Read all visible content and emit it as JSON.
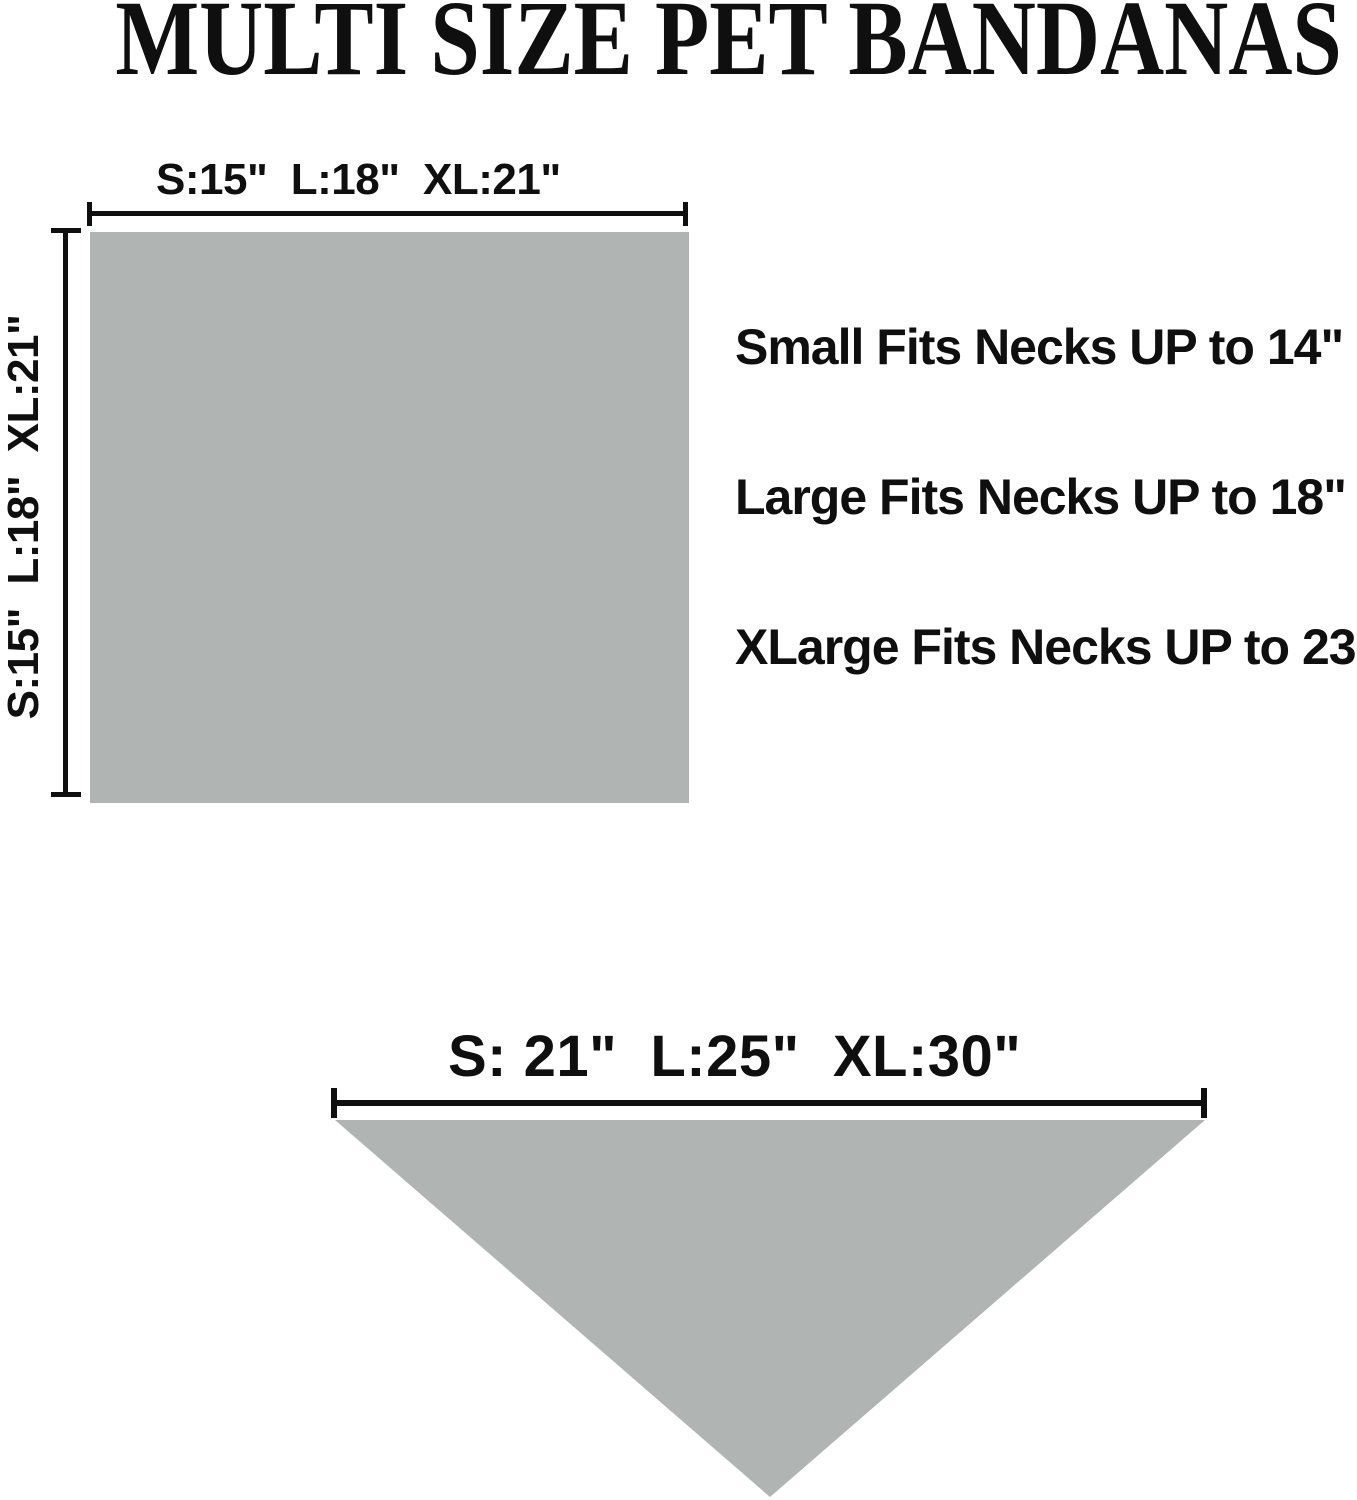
{
  "title": "MULTI SIZE PET BANDANAS",
  "colors": {
    "fabric_gray": "#b0b4b3",
    "ink": "#0f0f0f",
    "background": "#ffffff"
  },
  "flat_bandana": {
    "shape": "square",
    "width_label": "S:15\"  L:18\"  XL:21\"",
    "height_label": "S:15\"  L:18\"  XL:21\""
  },
  "fit_notes": [
    "Small Fits Necks UP to 14\"",
    "Large Fits Necks UP to 18\"",
    "XLarge Fits Necks UP to 23\""
  ],
  "folded_bandana": {
    "shape": "triangle",
    "width_label": "S: 21\"  L:25\"  XL:30\""
  }
}
